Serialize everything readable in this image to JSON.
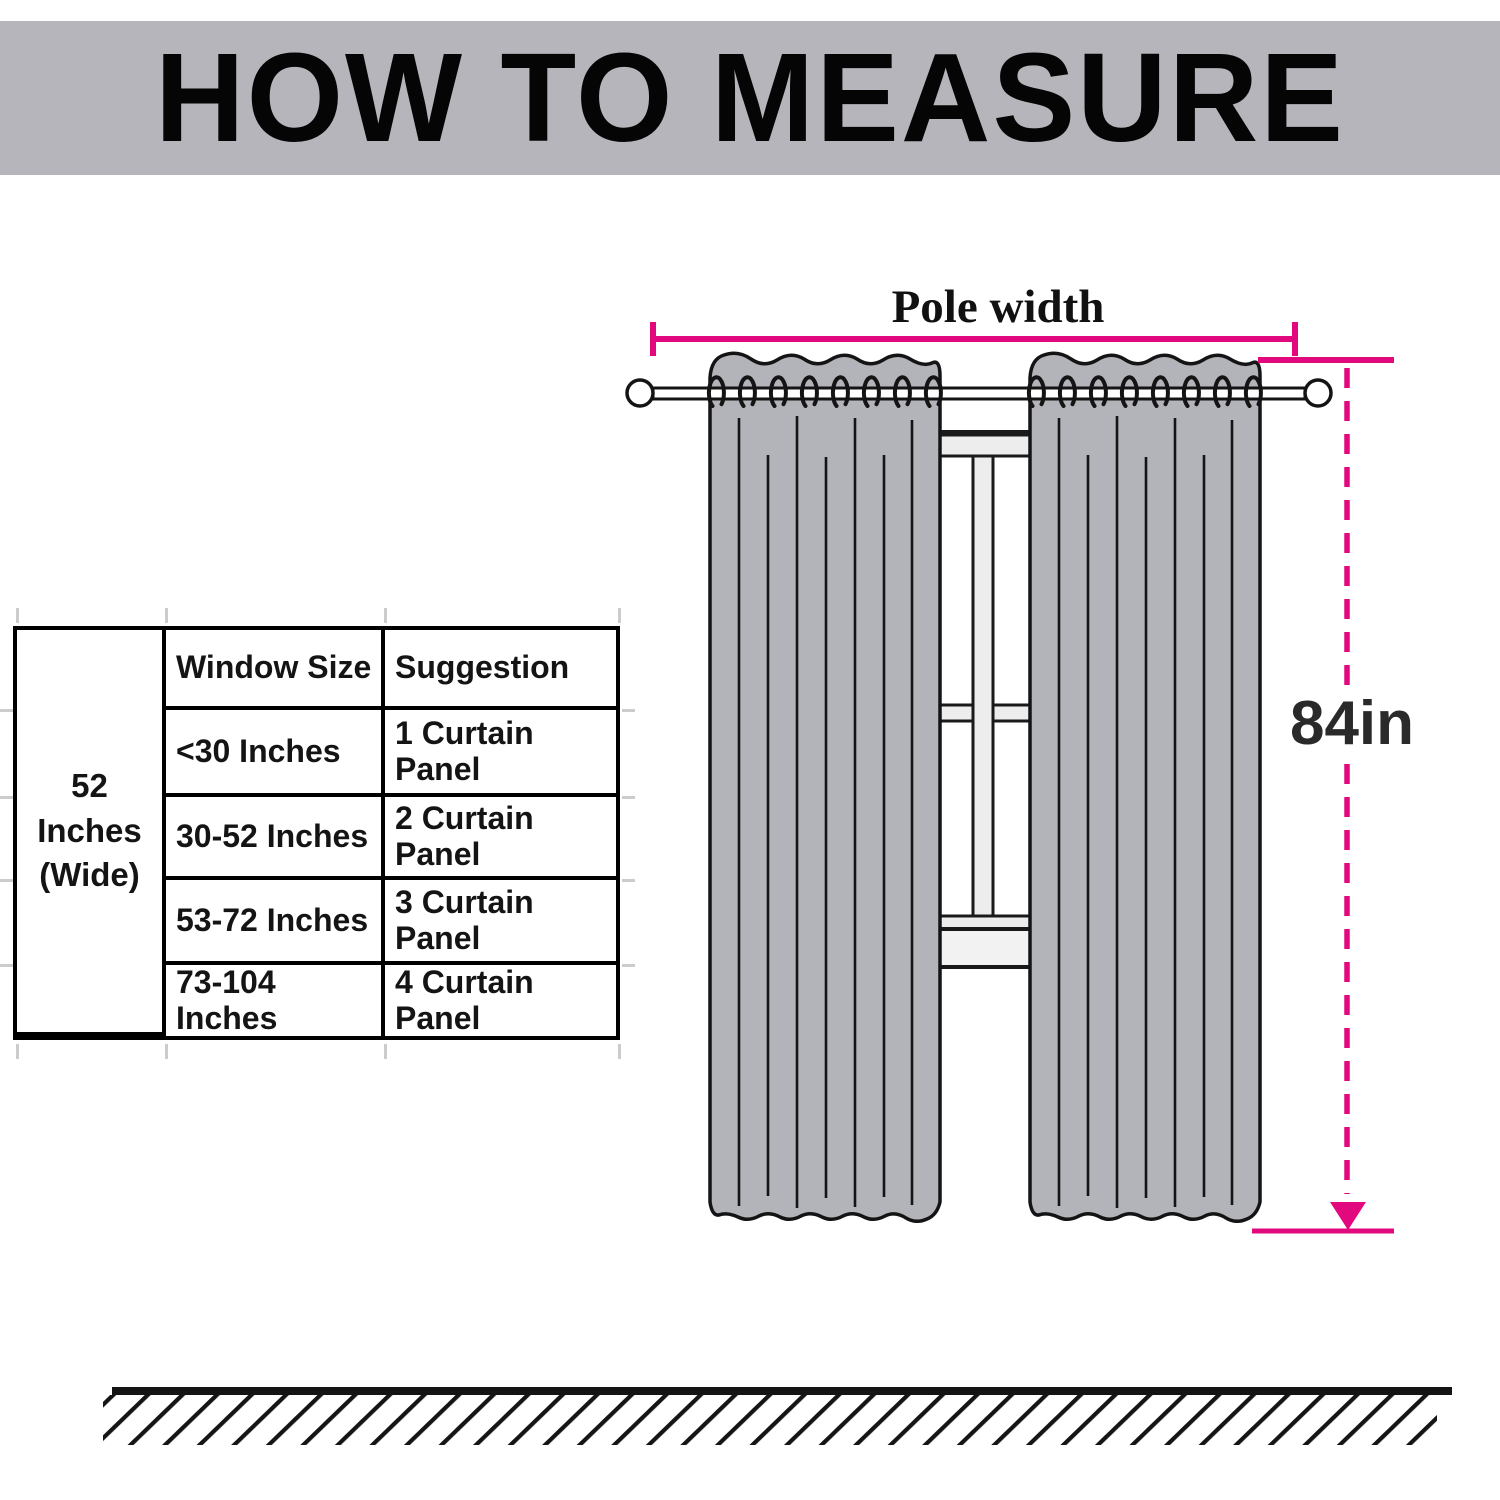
{
  "header": {
    "title": "HOW TO MEASURE",
    "bg_color": "#b5b5bb"
  },
  "size_table": {
    "width_label_line1": "52 Inches",
    "width_label_line2": "(Wide)",
    "columns": [
      "Window Size",
      "Suggestion"
    ],
    "rows": [
      {
        "window_size": "<30 Inches",
        "suggestion": "1 Curtain Panel"
      },
      {
        "window_size": "30-52 Inches",
        "suggestion": "2 Curtain Panel"
      },
      {
        "window_size": "53-72 Inches",
        "suggestion": "3 Curtain Panel"
      },
      {
        "window_size": "73-104 Inches",
        "suggestion": "4 Curtain Panel"
      }
    ]
  },
  "diagram": {
    "pole_width_label": "Pole width",
    "height_label": "84in",
    "panels": 2,
    "rings_per_panel": 8,
    "accent_color": "#e2097e",
    "curtain_color": "#b3b3ba",
    "frame_color": "#ededed",
    "sill_color": "#f2f2f2",
    "outline_color": "#141414"
  }
}
